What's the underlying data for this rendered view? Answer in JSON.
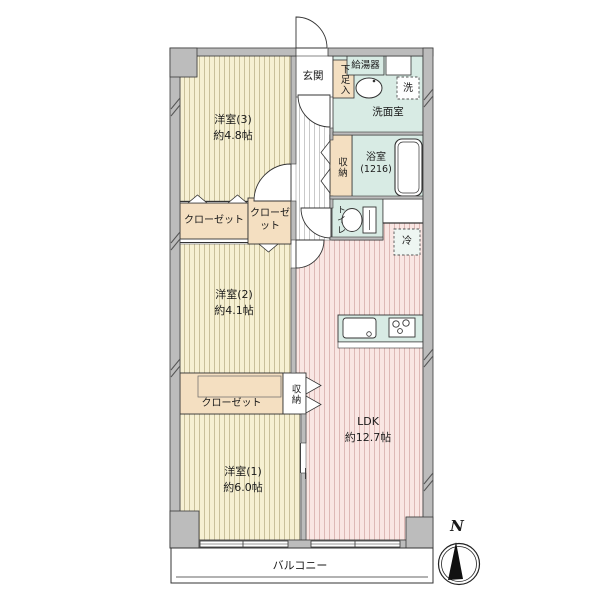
{
  "plan": {
    "type": "apartment-floor-plan",
    "rooms": {
      "room3_name": "洋室(3)",
      "room3_size": "約4.8帖",
      "room2_name": "洋室(2)",
      "room2_size": "約4.1帖",
      "room1_name": "洋室(1)",
      "room1_size": "約6.0帖",
      "ldk_name": "LDK",
      "ldk_size": "約12.7帖",
      "bathroom_name": "浴室",
      "bathroom_size": "(1216)"
    },
    "labels": {
      "genkan": "玄関",
      "shoe_box": "下足入",
      "water_heater": "給湯器",
      "washroom": "洗面室",
      "laundry": "洗",
      "toilet": "トイレ",
      "fridge": "冷",
      "storage_hall": "収納",
      "storage_ldk": "収納",
      "closet_room3": "クローゼット",
      "closet_room2": "クローゼット",
      "closet_room1": "クローゼット",
      "balcony": "バルコニー",
      "compass_north": "N"
    },
    "colors": {
      "wall_gray": "#bcbcbc",
      "western_room_floor": "#f6f0d2",
      "western_room_stripe": "#c9c09a",
      "ldk_floor": "#f9e6e3",
      "ldk_stripe": "#ddb9b6",
      "wet_area_teal": "#d8ebe4",
      "closet_beige": "#f4dfc1",
      "hall_stripe": "#c9c9c9",
      "outline": "#3a3a3a"
    }
  }
}
